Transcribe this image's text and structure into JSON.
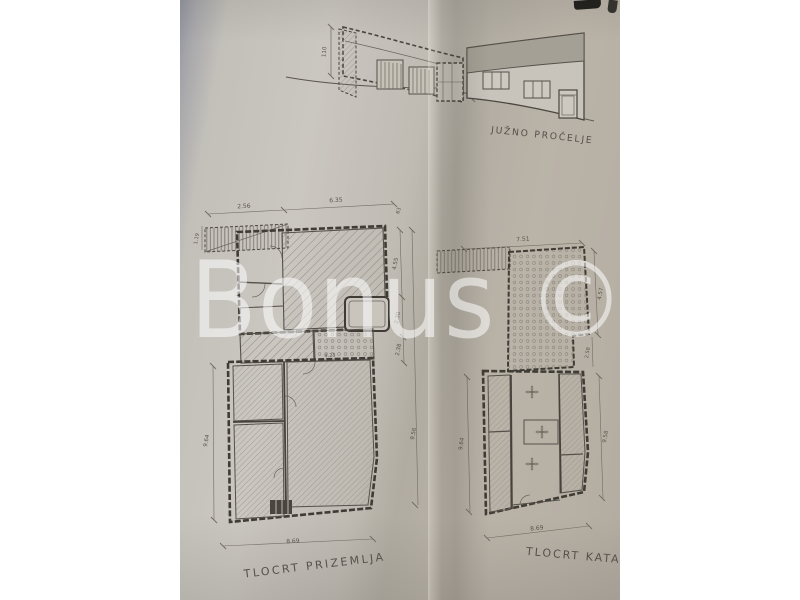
{
  "photo": {
    "watermark": "Bonus ©"
  },
  "elevation": {
    "label": "JUŽNO PROČELJE",
    "dims": {
      "wall_height": "110",
      "door_height": "240"
    }
  },
  "ground_plan": {
    "label": "TLOCRT PRIZEMLJA",
    "dims": {
      "top_left": "2.56",
      "top": "6.35",
      "top_right": "63",
      "left_top": "1.19",
      "left": "9.64",
      "right_1": "4.55",
      "right_2": "2.30",
      "right_3": "2.38",
      "right_total": "9.56",
      "bottom": "8.69",
      "inner": "4.23"
    }
  },
  "upper_plan": {
    "label": "TLOCRT KATA",
    "dims": {
      "top": "7.51",
      "left": "9.64",
      "right_terrace": "4.57",
      "right_small": "2.58",
      "right_total": "9.58",
      "bottom": "8.69"
    }
  },
  "colors": {
    "background": "#ffffff",
    "paper": "#c1bcb4",
    "paper_dark": "#b0aa9f",
    "edge_shadow": "#8f929d",
    "ink": "#4b473f",
    "roof_fill": "#a5a096",
    "watermark": "rgba(255,255,255,0.55)"
  }
}
